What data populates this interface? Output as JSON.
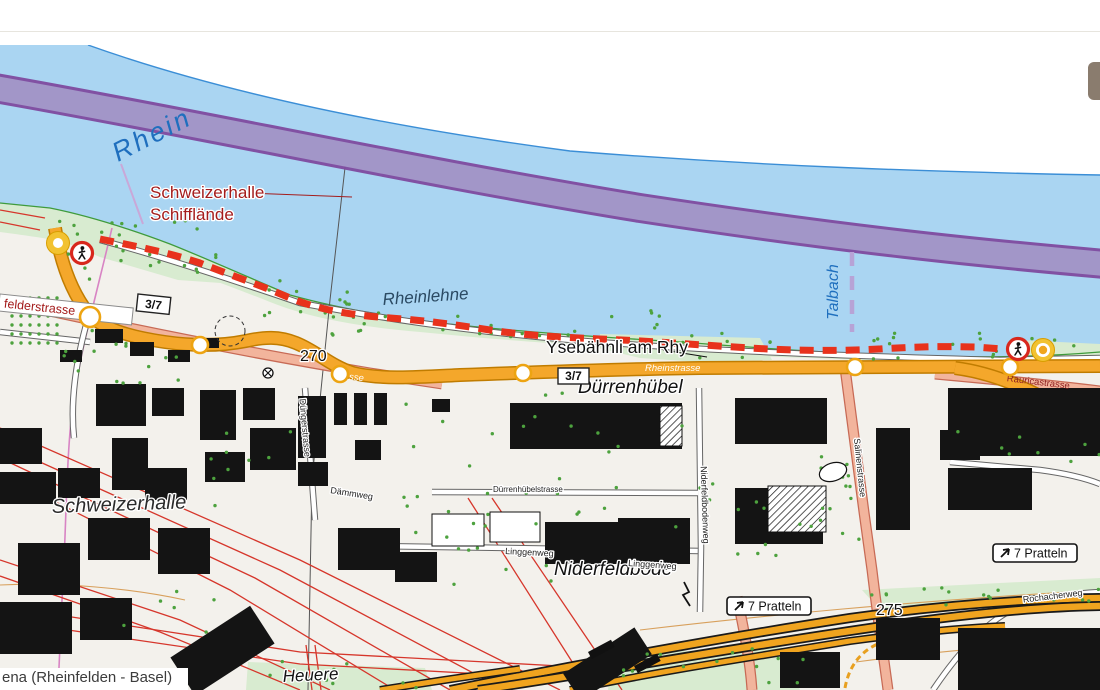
{
  "header": {},
  "panel_button": {
    "title": "map side panel toggle"
  },
  "overlay": {
    "route_name": "ena (Rheinfelden - Basel)"
  },
  "map": {
    "colors": {
      "water": "#aad5f2",
      "water_edge": "#3b8ed6",
      "land": "#f3f1ec",
      "north_bank": "#ffffff",
      "green": "#d8ebd0",
      "green_line": "#3f9b3c",
      "tree": "#4da23e",
      "purple_outer": "#7e4a9e",
      "purple_inner": "#a296c8",
      "talbach_dash": "#b7a3d6",
      "route_red": "#e8321c",
      "rail_red": "#d6362b",
      "orange_fill": "#f4a72b",
      "orange_case": "#c07c00",
      "salmon_fill": "#f2b49c",
      "salmon_case": "#c76a55",
      "motorway_fill": "#f0a41f",
      "motorway_case": "#1a1a1a",
      "building": "#141414",
      "label_red": "#a41c1c",
      "label_blue": "#1f6fbe",
      "marker_yellow": "#f2c230",
      "marker_ring": "#d89e00",
      "sign_red": "#d8271c",
      "contour": "#d8a05c",
      "pink_path": "#d884c4",
      "boundary": "#555555"
    },
    "labels": [
      {
        "id": "rhein",
        "text": "Rhein",
        "x": 118,
        "y": 162,
        "size": 27,
        "color": "#1f6fbe",
        "italic": true,
        "rotate": -27,
        "spacing": 3,
        "halo": false
      },
      {
        "id": "schiff1",
        "text": "Schweizerhalle",
        "x": 150,
        "y": 198,
        "size": 17,
        "color": "#a41c1c",
        "halo": true
      },
      {
        "id": "schiff2",
        "text": "Schifflände",
        "x": 150,
        "y": 220,
        "size": 17,
        "color": "#a41c1c",
        "halo": true
      },
      {
        "id": "rheinlehne",
        "text": "Rheinlehne",
        "x": 383,
        "y": 305,
        "size": 17,
        "color": "#2b4a63",
        "italic": true,
        "rotate": -4,
        "halo": false
      },
      {
        "id": "talbach",
        "text": "Talbach",
        "x": 838,
        "y": 292,
        "size": 16,
        "color": "#1f6fbe",
        "italic": true,
        "rotate": -90,
        "anchor": "middle",
        "halo": false
      },
      {
        "id": "ysebahnli",
        "text": "Ysebähnli am Rhy",
        "x": 546,
        "y": 353,
        "size": 17.5,
        "color": "#111111",
        "halo": true
      },
      {
        "id": "duerrenhuebel",
        "text": "Dürrenhübel",
        "x": 578,
        "y": 393,
        "size": 19,
        "color": "#111111",
        "italic": true,
        "halo": true
      },
      {
        "id": "niderfeldbode",
        "text": "Niderfeldbode",
        "x": 554,
        "y": 575,
        "size": 19,
        "color": "#111111",
        "italic": true,
        "halo": true
      },
      {
        "id": "schweizerhalle",
        "text": "Schweizerhalle",
        "x": 52,
        "y": 513,
        "size": 20,
        "color": "#2b2b2b",
        "italic": true,
        "rotate": -2,
        "halo": true
      },
      {
        "id": "heuere",
        "text": "Heuere",
        "x": 283,
        "y": 682,
        "size": 17,
        "color": "#111111",
        "italic": true,
        "rotate": -3,
        "halo": true
      },
      {
        "id": "elev270",
        "text": "270",
        "x": 300,
        "y": 361,
        "size": 16,
        "color": "#111111",
        "halo": true
      },
      {
        "id": "elev275",
        "text": "275",
        "x": 876,
        "y": 615,
        "size": 16,
        "color": "#111111",
        "halo": true
      },
      {
        "id": "rheinstrasse",
        "text": "Rheinstrasse",
        "x": 645,
        "y": 371,
        "size": 9.5,
        "color": "#ffffff",
        "italic": true,
        "halo": false
      },
      {
        "id": "strasse-frag",
        "text": "strasse",
        "x": 333,
        "y": 378,
        "size": 9.5,
        "color": "#ffffff",
        "italic": true,
        "rotate": 6,
        "halo": false
      },
      {
        "id": "rauricastrasse",
        "text": "Rauricastrasse",
        "x": 1038,
        "y": 385,
        "size": 9.5,
        "color": "#8f2020",
        "rotate": 7,
        "anchor": "middle",
        "halo": false
      },
      {
        "id": "salinenstrasse",
        "text": "Salinenstrasse",
        "x": 857,
        "y": 468,
        "size": 9,
        "color": "#222222",
        "rotate": 84,
        "anchor": "middle",
        "halo": true
      },
      {
        "id": "duengerstrasse",
        "text": "Düngerstrasse",
        "x": 302,
        "y": 428,
        "size": 9,
        "color": "#222222",
        "rotate": 85,
        "anchor": "middle",
        "halo": true
      },
      {
        "id": "daemmweg",
        "text": "Dämmweg",
        "x": 330,
        "y": 493,
        "size": 9,
        "color": "#222222",
        "rotate": 9,
        "halo": true
      },
      {
        "id": "linggenweg1",
        "text": "Linggenweg",
        "x": 505,
        "y": 554,
        "size": 9,
        "color": "#222222",
        "rotate": 3,
        "halo": true
      },
      {
        "id": "linggenweg2",
        "text": "Linggenweg",
        "x": 628,
        "y": 566,
        "size": 9,
        "color": "#222222",
        "rotate": 4,
        "halo": true
      },
      {
        "id": "niderfeldbodenweg",
        "text": "Niderfeldbodenweg",
        "x": 702,
        "y": 505,
        "size": 9,
        "color": "#222222",
        "rotate": 88,
        "anchor": "middle",
        "halo": true
      },
      {
        "id": "rochacherweg",
        "text": "Rochacherweg",
        "x": 1053,
        "y": 599,
        "size": 9,
        "color": "#222222",
        "rotate": -7,
        "anchor": "middle",
        "halo": true
      },
      {
        "id": "duerrenhuebelstrasse",
        "text": "Dürrenhübelstrasse",
        "x": 493,
        "y": 492,
        "size": 8,
        "color": "#222222",
        "halo": true
      }
    ],
    "boxed_street_label": {
      "text": "felderstrasse",
      "x": 0,
      "y": 294,
      "w": 134,
      "h": 17,
      "rotate": 6
    },
    "route_shields": [
      {
        "text": "3/7",
        "x": 138,
        "y": 294,
        "w": 33,
        "h": 17,
        "rotate": 6
      },
      {
        "text": "3/7",
        "x": 558,
        "y": 368,
        "w": 31,
        "h": 16,
        "rotate": 0
      }
    ],
    "direction_signs": [
      {
        "text": "7 Pratteln",
        "x": 993,
        "y": 544,
        "w": 84,
        "h": 18
      },
      {
        "text": "7 Pratteln",
        "x": 727,
        "y": 597,
        "w": 84,
        "h": 18
      }
    ],
    "geometry": {
      "water_path": "M0,45 L88,45 C220,92 380,126 570,151 C760,166 930,172 1100,175 L1100,352 C1040,357 980,358 920,356 C840,354 760,348 680,342 C600,337 520,332 440,323 C380,316 330,306 290,295 C250,278 210,260 170,244 C130,229 90,216 50,208 L0,203 Z",
      "north_bank_line": "M88,45 C220,92 380,126 570,151 C760,166 930,172 1100,175",
      "south_shore_line": "M0,203 L50,208 C90,216 130,229 170,244 C210,260 250,278 290,295 C330,306 380,316 440,323 C520,332 600,337 680,342 C760,348 840,354 920,356 C980,358 1040,357 1100,352",
      "green_strip": "M0,203 L50,208 C90,216 130,229 170,244 C210,260 250,278 290,295 C330,306 380,316 440,323 C520,332 600,337 680,342 C760,348 840,354 920,356 C980,358 1040,357 1100,352 L1100,362 C1040,367 1010,368 960,364 C900,361 840,359 780,357 C720,354 660,350 600,346 C540,343 480,338 420,332 C360,327 310,318 270,302 C220,282 170,264 120,252 C60,240 30,236 0,232 Z",
      "green_patches": [
        "M40,216 L140,234 L215,262 L235,284 L178,280 L100,257 L45,234 Z",
        "M600,334 L760,338 L772,360 L700,362 L640,358 L598,348 Z",
        "M1018,340 L1100,344 L1100,368 L1030,368 Z",
        "M862,590 L1100,578 L1100,602 L880,610 Z",
        "M612,654 L782,647 L800,690 L608,690 Z",
        "M248,662 L425,668 L432,690 L246,690 Z"
      ],
      "purple_path": "M-5,88 C200,124 420,172 640,208 C850,240 980,253 1105,264",
      "talbach_dash": {
        "x": 852,
        "y1": 252,
        "y2": 332
      },
      "schiff_line": {
        "x1": 121,
        "y1": 164,
        "x2": 143,
        "y2": 224
      },
      "leader_schiff": {
        "x1": 247,
        "y1": 193,
        "x2": 352,
        "y2": 197
      },
      "leader_yse": {
        "x1": 663,
        "y1": 350,
        "x2": 707,
        "y2": 357
      },
      "boundary": "M347,150 L330,300 L312,480 L308,690",
      "pink_path": "M112,228 C95,300 78,360 72,412 C66,462 66,540 62,600 L58,690",
      "contours": [
        "M640,630 C760,616 900,602 1100,590",
        "M856,662 C930,652 1010,645 1100,640",
        "M0,585 C60,582 130,588 185,600"
      ],
      "railways": [
        [
          [
            0,
            428
          ],
          [
            300,
            560
          ],
          [
            560,
            690
          ]
        ],
        [
          [
            0,
            444
          ],
          [
            280,
            570
          ],
          [
            505,
            690
          ]
        ],
        [
          [
            0,
            458
          ],
          [
            255,
            578
          ],
          [
            450,
            690
          ]
        ],
        [
          [
            0,
            474
          ],
          [
            230,
            590
          ],
          [
            395,
            690
          ]
        ],
        [
          [
            0,
            560
          ],
          [
            180,
            620
          ],
          [
            330,
            690
          ]
        ],
        [
          [
            0,
            576
          ],
          [
            160,
            632
          ],
          [
            300,
            690
          ]
        ],
        [
          [
            0,
            606
          ],
          [
            300,
            652
          ],
          [
            560,
            666
          ]
        ],
        [
          [
            0,
            620
          ],
          [
            300,
            664
          ],
          [
            520,
            676
          ]
        ],
        [
          [
            468,
            498
          ],
          [
            590,
            690
          ]
        ],
        [
          [
            492,
            498
          ],
          [
            622,
            690
          ]
        ],
        [
          [
            306,
            645
          ],
          [
            312,
            690
          ]
        ],
        [
          [
            315,
            645
          ],
          [
            321,
            690
          ]
        ],
        [
          [
            0,
            210
          ],
          [
            45,
            218
          ]
        ],
        [
          [
            0,
            222
          ],
          [
            40,
            230
          ]
        ]
      ],
      "minor_roads": [
        "M100,240 C160,256 230,279 300,303 C380,318 460,330 560,339 C700,351 850,356 1000,360 L1100,358",
        "M375,546 L700,551",
        "M699,388 L701,548 L700,612",
        "M432,492 L698,493",
        "M933,690 C960,650 990,618 1020,606 C1050,596 1080,593 1100,592",
        "M305,388 L315,520",
        "M0,332 L90,342",
        "M88,318 C76,360 70,400 74,438",
        "M950,462 L1040,470 C1070,474 1090,480 1100,484"
      ],
      "salmon_roads": [
        "M0,300 C120,327 250,353 370,373 L442,384",
        "M935,374 C1000,380 1060,386 1100,391",
        "M845,368 C852,420 862,500 872,570 C878,620 884,660 888,690",
        "M737,597 C744,630 750,660 752,690"
      ],
      "orange_roads": [
        "M55,228 C60,258 70,290 88,313 C102,329 130,337 165,342 C200,347 226,345 246,341 C264,337 279,336 296,343 C316,351 331,366 353,373 C382,380 420,377 460,375 C540,372 620,369 700,368 C800,367 950,367 1100,366",
        "M955,368 C995,373 1035,392 1065,410 C1085,422 1095,427 1100,429"
      ],
      "motorway_main": [
        "M450,690 C560,668 700,641 850,618 C950,604 1030,599 1100,598",
        "M478,690 C590,674 720,650 870,628 C970,613 1040,607 1100,606"
      ],
      "motorway_ramps": [
        "M570,690 C660,671 760,656 850,641 C910,633 960,628 1005,626",
        "M380,690 C430,682 470,676 520,669"
      ],
      "motorway_dashed_arc": "M845,688 C850,660 868,642 900,638",
      "dashed_circle": {
        "cx": 230,
        "cy": 331,
        "r": 15
      },
      "oval_loop": {
        "cx": 833,
        "cy": 472,
        "rx": 14,
        "ry": 9,
        "rot": -18
      },
      "barrier": {
        "cx": 268,
        "cy": 373
      },
      "lightning": "M684,582 L689,592 L683,595 L690,606",
      "portal_bars": [
        [
          588,
          652,
          26,
          8,
          -28
        ],
        [
          634,
          666,
          26,
          8,
          -28
        ]
      ],
      "route_dashes": "M100,239 C140,247 170,253 200,263 C235,277 255,283 290,298 C320,310 350,315 390,318 C430,321 450,324 490,330 C530,336 560,337 600,339 C650,341 700,345 750,348 C800,351 840,351 880,349 C910,347 940,346 975,347 L1002,349",
      "buildings": [
        [
          95,
          329,
          28,
          14
        ],
        [
          130,
          342,
          24,
          14
        ],
        [
          168,
          350,
          22,
          12
        ],
        [
          205,
          338,
          14,
          10
        ],
        [
          60,
          350,
          22,
          12
        ],
        [
          96,
          384,
          50,
          42
        ],
        [
          152,
          388,
          32,
          28
        ],
        [
          200,
          390,
          36,
          50
        ],
        [
          243,
          388,
          32,
          32
        ],
        [
          298,
          396,
          28,
          62
        ],
        [
          334,
          393,
          13,
          32
        ],
        [
          354,
          393,
          13,
          32
        ],
        [
          374,
          393,
          13,
          32
        ],
        [
          250,
          428,
          46,
          42
        ],
        [
          205,
          452,
          40,
          30
        ],
        [
          112,
          438,
          36,
          52
        ],
        [
          58,
          468,
          42,
          30
        ],
        [
          0,
          428,
          42,
          36
        ],
        [
          0,
          472,
          56,
          32
        ],
        [
          145,
          468,
          42,
          32
        ],
        [
          88,
          518,
          62,
          42
        ],
        [
          158,
          528,
          52,
          46
        ],
        [
          18,
          543,
          62,
          52
        ],
        [
          0,
          602,
          72,
          52
        ],
        [
          80,
          598,
          52,
          42
        ],
        [
          338,
          528,
          62,
          42
        ],
        [
          395,
          552,
          42,
          30
        ],
        [
          510,
          403,
          172,
          46
        ],
        [
          735,
          398,
          92,
          46
        ],
        [
          948,
          388,
          152,
          68
        ],
        [
          876,
          428,
          34,
          102
        ],
        [
          948,
          468,
          84,
          42
        ],
        [
          735,
          488,
          88,
          56
        ],
        [
          618,
          518,
          72,
          46
        ],
        [
          545,
          522,
          142,
          42
        ],
        [
          432,
          399,
          18,
          13
        ],
        [
          958,
          628,
          142,
          62
        ],
        [
          876,
          618,
          64,
          42
        ],
        [
          298,
          462,
          30,
          24
        ],
        [
          355,
          440,
          26,
          20
        ],
        [
          175,
          628,
          95,
          45,
          -33
        ],
        [
          565,
          648,
          85,
          32,
          -33
        ],
        [
          780,
          652,
          60,
          36
        ],
        [
          940,
          430,
          40,
          30
        ]
      ],
      "hatched": [
        [
          660,
          406,
          22,
          40
        ],
        [
          768,
          486,
          58,
          46
        ]
      ],
      "white_sheds": [
        [
          432,
          514,
          52,
          32
        ],
        [
          490,
          512,
          50,
          30
        ]
      ],
      "tree_regions": [
        [
          50,
          220,
          170,
          60,
          28,
          0
        ],
        [
          240,
          280,
          120,
          40,
          14,
          0
        ],
        [
          330,
          305,
          330,
          32,
          26,
          0
        ],
        [
          670,
          332,
          420,
          28,
          26,
          0
        ],
        [
          8,
          294,
          52,
          52,
          0,
          1
        ],
        [
          60,
          330,
          120,
          60,
          16,
          0
        ],
        [
          190,
          425,
          130,
          90,
          10,
          0
        ],
        [
          390,
          390,
          330,
          150,
          30,
          0
        ],
        [
          700,
          450,
          170,
          110,
          16,
          0
        ],
        [
          430,
          515,
          130,
          70,
          10,
          0
        ],
        [
          870,
          582,
          230,
          26,
          16,
          0
        ],
        [
          620,
          648,
          190,
          40,
          14,
          0
        ],
        [
          255,
          660,
          170,
          28,
          10,
          0
        ],
        [
          950,
          425,
          150,
          40,
          8,
          0
        ],
        [
          100,
          580,
          120,
          80,
          6,
          0
        ],
        [
          820,
          440,
          40,
          110,
          10,
          0
        ]
      ],
      "waypoints": [
        [
          90,
          317,
          10
        ],
        [
          200,
          345,
          8
        ],
        [
          340,
          374,
          8
        ],
        [
          523,
          373,
          8
        ],
        [
          855,
          367,
          8
        ],
        [
          1010,
          367,
          8
        ]
      ],
      "pedestrian_signs": [
        [
          82,
          253
        ],
        [
          1018,
          349
        ]
      ],
      "start_marker": [
        58,
        243
      ],
      "end_marker": [
        1043,
        350
      ]
    }
  }
}
